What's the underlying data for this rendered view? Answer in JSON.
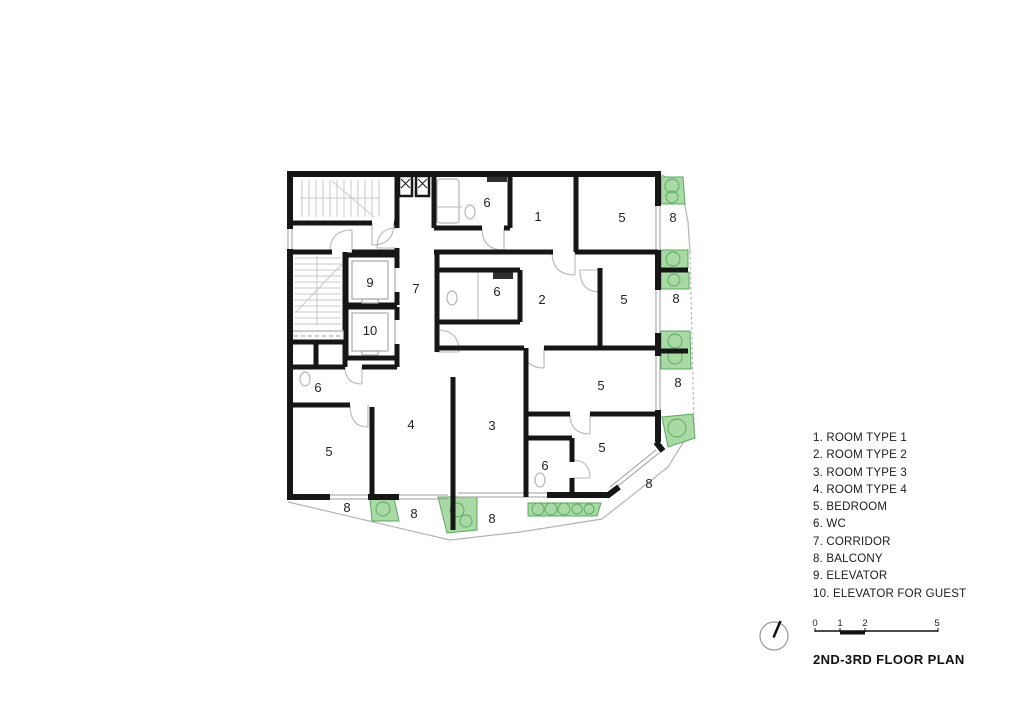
{
  "title": "2ND-3RD FLOOR PLAN",
  "legend": {
    "items": [
      "1. ROOM TYPE 1",
      "2. ROOM TYPE 2",
      "3. ROOM TYPE 3",
      "4. ROOM TYPE 4",
      "5. BEDROOM",
      "6. WC",
      "7. CORRIDOR",
      "8. BALCONY",
      "9. ELEVATOR",
      "10. ELEVATOR FOR GUEST"
    ]
  },
  "scale_bar": {
    "ticks": [
      {
        "t": "0",
        "x": 815
      },
      {
        "t": "1",
        "x": 840
      },
      {
        "t": "2",
        "x": 865
      },
      {
        "t": "5",
        "x": 937
      }
    ]
  },
  "plan": {
    "colors": {
      "wall": "#161616",
      "planter_fill": "#a9d9a4",
      "planter_line": "#58a85f",
      "detail_line": "#b5b5b5"
    },
    "labels": [
      {
        "t": "6",
        "x": 487,
        "y": 207
      },
      {
        "t": "1",
        "x": 538,
        "y": 221
      },
      {
        "t": "5",
        "x": 622,
        "y": 222
      },
      {
        "t": "8",
        "x": 673,
        "y": 222
      },
      {
        "t": "9",
        "x": 370,
        "y": 287
      },
      {
        "t": "7",
        "x": 416,
        "y": 293
      },
      {
        "t": "6",
        "x": 497,
        "y": 296
      },
      {
        "t": "2",
        "x": 542,
        "y": 304
      },
      {
        "t": "5",
        "x": 624,
        "y": 304
      },
      {
        "t": "8",
        "x": 676,
        "y": 303
      },
      {
        "t": "10",
        "x": 370,
        "y": 335
      },
      {
        "t": "6",
        "x": 318,
        "y": 392
      },
      {
        "t": "5",
        "x": 601,
        "y": 390
      },
      {
        "t": "8",
        "x": 678,
        "y": 387
      },
      {
        "t": "5",
        "x": 329,
        "y": 456
      },
      {
        "t": "4",
        "x": 411,
        "y": 429
      },
      {
        "t": "3",
        "x": 492,
        "y": 430
      },
      {
        "t": "6",
        "x": 545,
        "y": 470
      },
      {
        "t": "5",
        "x": 602,
        "y": 452
      },
      {
        "t": "8",
        "x": 649,
        "y": 488
      },
      {
        "t": "8",
        "x": 347,
        "y": 512
      },
      {
        "t": "8",
        "x": 414,
        "y": 518
      },
      {
        "t": "8",
        "x": 492,
        "y": 523
      }
    ]
  }
}
